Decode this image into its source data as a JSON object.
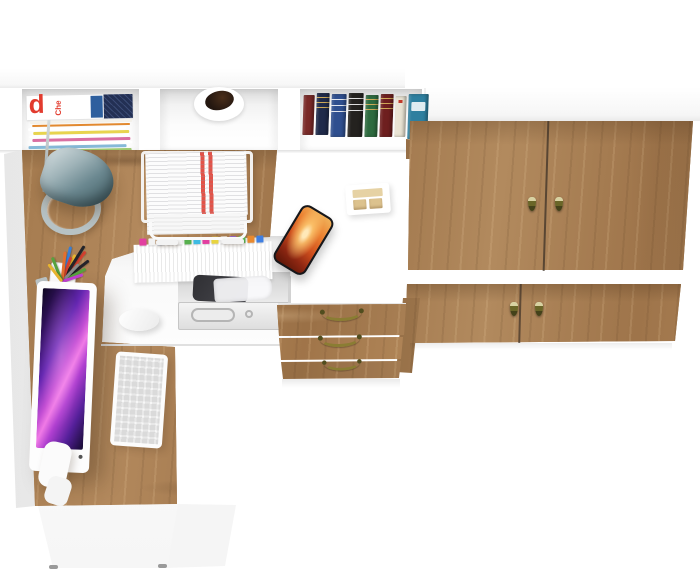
{
  "scene": {
    "description": "Top-down render of a white and oak corner desk workstation with hutch shelf, under-desk printer shelf, three-drawer pedestal and a two-door wardrobe cabinet",
    "background_color": "#ffffff",
    "wood_color": "#a67c50",
    "white_body_color": "#ffffff"
  },
  "hutch": {
    "magazine_cover": {
      "letter": "d",
      "masthead": "Che",
      "letter_color": "#e23b2e",
      "band_color": "#2e5f9e",
      "block_color": "#233054"
    },
    "magazine_stripes": [
      {
        "c": "#f4f1ea",
        "h": 3,
        "o": 0
      },
      {
        "c": "#e2892f",
        "h": 2,
        "o": 2
      },
      {
        "c": "#ffffff",
        "h": 3,
        "o": -2
      },
      {
        "c": "#e8d44f",
        "h": 3,
        "o": 3
      },
      {
        "c": "#ffffff",
        "h": 2,
        "o": -1
      },
      {
        "c": "#d96fa2",
        "h": 3,
        "o": 2
      },
      {
        "c": "#ffffff",
        "h": 2,
        "o": 0
      },
      {
        "c": "#86b9d8",
        "h": 3,
        "o": -2
      },
      {
        "c": "#9fc86f",
        "h": 3,
        "o": 1
      },
      {
        "c": "#f0ede8",
        "h": 3,
        "o": -1
      },
      {
        "c": "#cfd8dc",
        "h": 2,
        "o": 2
      }
    ],
    "pot": {
      "body_color": "#ffffff",
      "inside_color": "#241710"
    },
    "books": [
      {
        "color": "#7a2a28",
        "width": 11,
        "height": 40,
        "top": 2,
        "mark": "none"
      },
      {
        "color": "#1f2a4a",
        "width": 13,
        "height": 42,
        "top": 0,
        "mark": "gold"
      },
      {
        "color": "#2f4f8f",
        "width": 15,
        "height": 43,
        "top": 1,
        "mark": "white"
      },
      {
        "color": "#24221f",
        "width": 15,
        "height": 44,
        "top": 0,
        "mark": "white"
      },
      {
        "color": "#2e6b3f",
        "width": 13,
        "height": 42,
        "top": 2,
        "mark": "gold"
      },
      {
        "color": "#6e1f1f",
        "width": 13,
        "height": 43,
        "top": 1,
        "mark": "gold"
      },
      {
        "color": "#e9e3d3",
        "width": 11,
        "height": 41,
        "top": 3,
        "mark": "red"
      },
      {
        "color": "#2e7f9f",
        "width": 20,
        "height": 45,
        "top": 1,
        "mark": "label"
      }
    ]
  },
  "wardrobe": {
    "door_count": 4,
    "handle_color": "#6a6628",
    "handle_cap_color": "#d8d2a2"
  },
  "pedestal": {
    "drawer_count": 3,
    "handle_color": "#8a7d33"
  },
  "under_desk": {
    "tabs": [
      "#e23fa0",
      "#f2f2f2",
      "#3f7fe2",
      "#e8892f",
      "#f2f2f2",
      "#57b04e",
      "#3fbbe2",
      "#e23fa0",
      "#e8d43f",
      "#f2f2f2",
      "#8f5fd4",
      "#57b04e",
      "#e8892f",
      "#3f7fe2"
    ],
    "printer_color": "#3a3a40",
    "shelf_color": "#e9e9e9"
  },
  "accessories": {
    "paper_stripe_color": "#e25248",
    "lamp_color": "#7d979c",
    "monitor_screen_colors": [
      "#0e081f",
      "#6326b0",
      "#c44fd4",
      "#f07ae6",
      "#140a2e"
    ],
    "phone_screen_colors": [
      "#ffe9b8",
      "#ec8030",
      "#cf4f1d",
      "#5a1507"
    ],
    "pens": [
      {
        "c": "#23242a",
        "a": -38,
        "l": 34
      },
      {
        "c": "#d4402f",
        "a": -52,
        "l": 38
      },
      {
        "c": "#e8b52f",
        "a": -64,
        "l": 30
      },
      {
        "c": "#3a7fd4",
        "a": -76,
        "l": 36
      },
      {
        "c": "#57a23e",
        "a": -28,
        "l": 27
      },
      {
        "c": "#23242a",
        "a": -58,
        "l": 42
      },
      {
        "c": "#d4402f",
        "a": -70,
        "l": 26
      },
      {
        "c": "#8a8a8a",
        "a": -46,
        "l": 24
      },
      {
        "c": "#e2702f",
        "a": -84,
        "l": 30
      },
      {
        "c": "#c23fd4",
        "a": -18,
        "l": 22
      },
      {
        "c": "#57a23e",
        "a": -112,
        "l": 26
      },
      {
        "c": "#e8b52f",
        "a": -128,
        "l": 22
      }
    ]
  }
}
